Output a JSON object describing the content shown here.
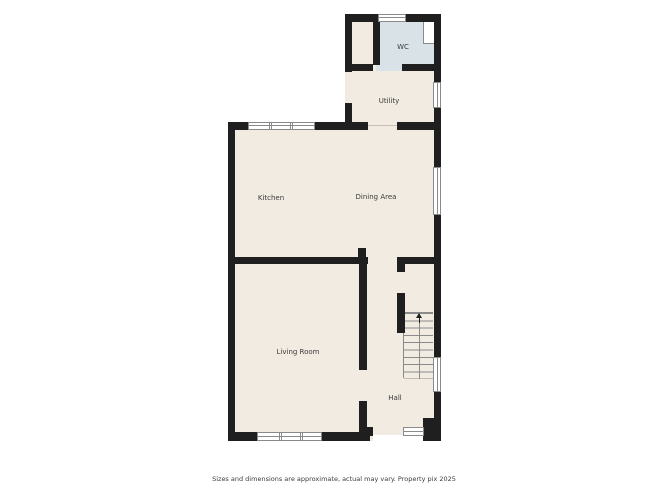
{
  "floorplan": {
    "rooms": [
      {
        "id": "wc",
        "label": "WC"
      },
      {
        "id": "utility",
        "label": "Utility"
      },
      {
        "id": "kitchen",
        "label": "Kitchen"
      },
      {
        "id": "dining",
        "label": "Dining Area"
      },
      {
        "id": "living",
        "label": "Living Room"
      },
      {
        "id": "hall",
        "label": "Hall"
      }
    ],
    "stairs": {
      "direction": "up",
      "treads": 9
    },
    "colors": {
      "wall": "#1f1f1f",
      "floor": "#f2ebe1",
      "wc_floor": "#d9e3e7",
      "window": "#ffffff",
      "window_frame": "#8a8a8a",
      "stair_line": "#8a8a8a",
      "threshold": "#c8c0b4",
      "label": "#3a3a3a",
      "caption": "#3b3b3b"
    },
    "caption": "Sizes and dimensions are approximate, actual may vary. Property pix 2025"
  }
}
